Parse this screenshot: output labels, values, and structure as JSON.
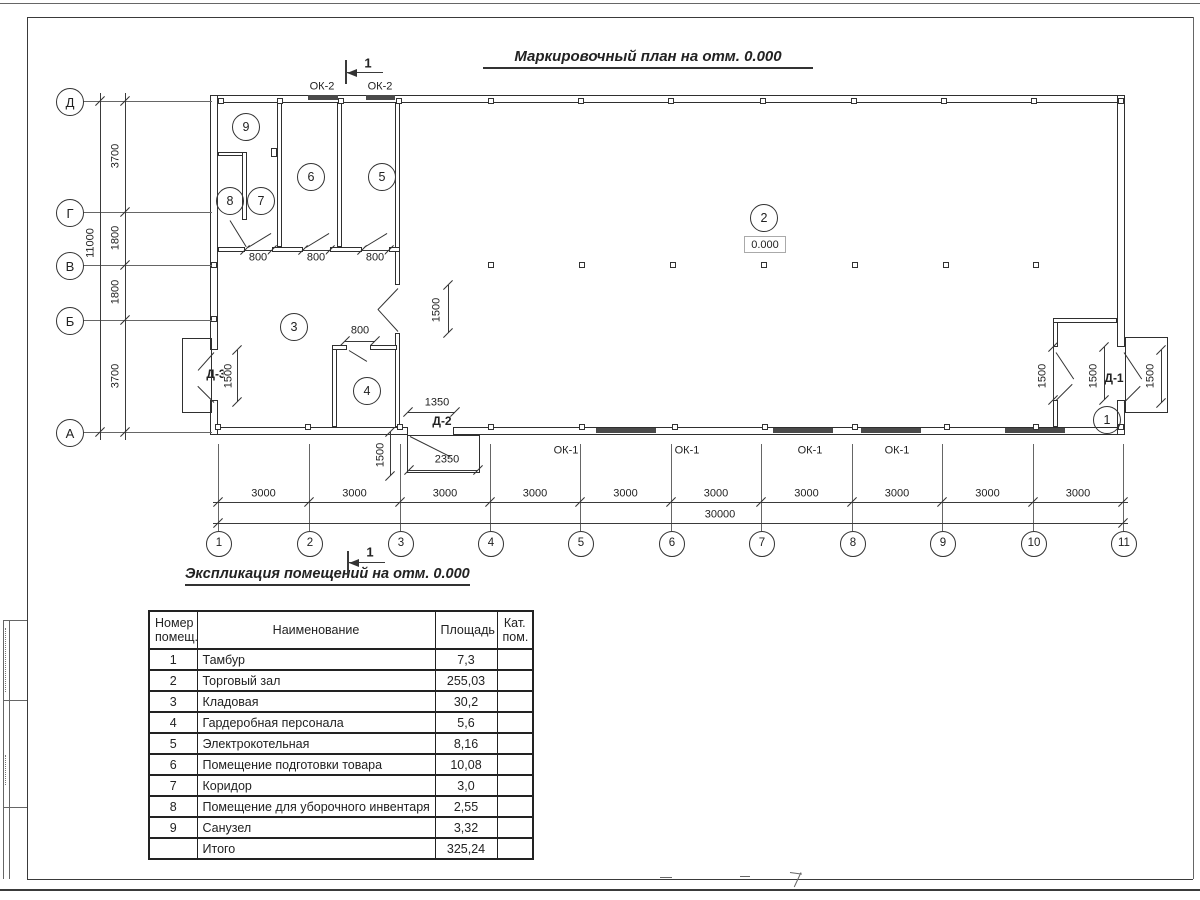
{
  "sheet": {
    "plan_title": "Маркировочный план на отм. 0.000",
    "explication_title": "Экспликация помещений на отм. 0.000",
    "section_label": "1"
  },
  "plan": {
    "elevation": "0.000",
    "rooms": [
      "1",
      "2",
      "3",
      "4",
      "5",
      "6",
      "7",
      "8",
      "9"
    ],
    "window_marks": {
      "ok2": [
        "ОК-2",
        "ОК-2"
      ],
      "ok1": [
        "ОК-1",
        "ОК-1",
        "ОК-1",
        "ОК-1"
      ]
    },
    "door_marks": {
      "d3": "Д-3",
      "d2": "Д-2",
      "d1": "Д-1"
    },
    "axes": {
      "horizontal": [
        "1",
        "2",
        "3",
        "4",
        "5",
        "6",
        "7",
        "8",
        "9",
        "10",
        "11"
      ],
      "vertical": [
        "Д",
        "Г",
        "В",
        "Б",
        "А"
      ]
    },
    "dims": {
      "h_segments": [
        "3000",
        "3000",
        "3000",
        "3000",
        "3000",
        "3000",
        "3000",
        "3000",
        "3000",
        "3000"
      ],
      "h_total": "30000",
      "v_segments": [
        "3700",
        "1800",
        "1800",
        "3700"
      ],
      "v_total": "11000",
      "openings_800": [
        "800",
        "800",
        "800",
        "800"
      ],
      "openings_1500": [
        "1500",
        "1500",
        "1500",
        "1500",
        "1500",
        "1500"
      ],
      "d2_opening": "1350",
      "d2_porch": "2350"
    }
  },
  "table": {
    "headers": {
      "number": "Номер\nпомещ.",
      "name": "Наименование",
      "area": "Площадь",
      "category": "Кат.\nпом."
    },
    "rows": [
      {
        "number": "1",
        "name": "Тамбур",
        "area": "7,3",
        "category": ""
      },
      {
        "number": "2",
        "name": "Торговый зал",
        "area": "255,03",
        "category": ""
      },
      {
        "number": "3",
        "name": "Кладовая",
        "area": "30,2",
        "category": ""
      },
      {
        "number": "4",
        "name": "Гардеробная персонала",
        "area": "5,6",
        "category": ""
      },
      {
        "number": "5",
        "name": "Электрокотельная",
        "area": "8,16",
        "category": ""
      },
      {
        "number": "6",
        "name": "Помещение подготовки товара",
        "area": "10,08",
        "category": ""
      },
      {
        "number": "7",
        "name": "Коридор",
        "area": "3,0",
        "category": ""
      },
      {
        "number": "8",
        "name": "Помещение для уборочного инвентаря",
        "area": "2,55",
        "category": ""
      },
      {
        "number": "9",
        "name": "Санузел",
        "area": "3,32",
        "category": ""
      },
      {
        "number": "",
        "name": "Итого",
        "area": "325,24",
        "category": ""
      }
    ]
  }
}
